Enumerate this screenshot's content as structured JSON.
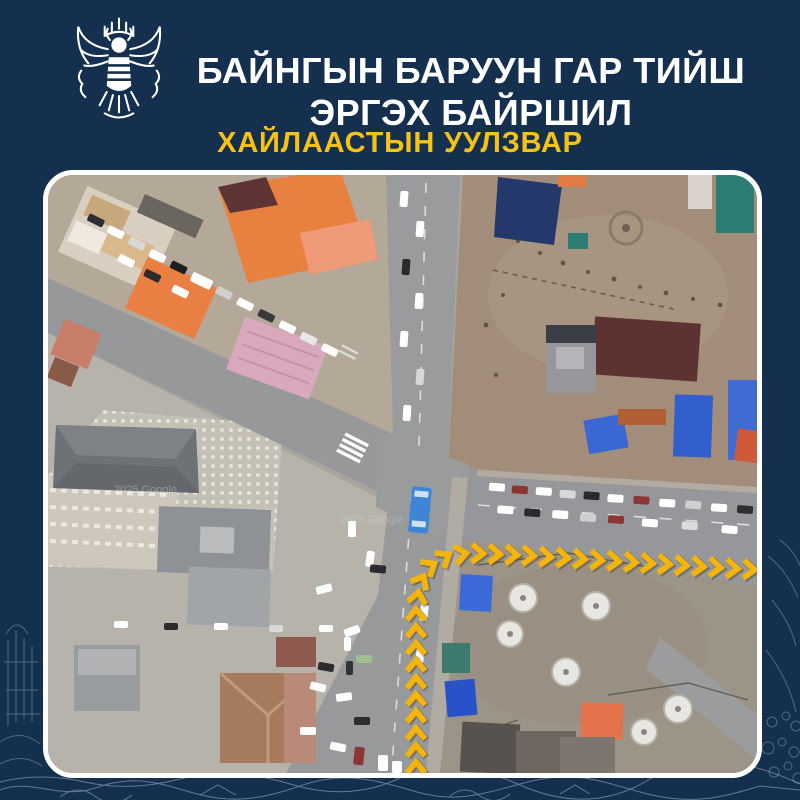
{
  "colors": {
    "background": "#15304e",
    "title_text": "#ffffff",
    "subtitle_text": "#f6c216",
    "map_border": "#ffffff",
    "route_chevron": "#f3b40b",
    "route_shadow": "#4b4237"
  },
  "header": {
    "emblem": "traffic-police-garuda-emblem",
    "title_line1": "БАЙНГЫН БАРУУН ГАР ТИЙШ",
    "title_line2": "ЭРГЭХ БАЙРШИЛ",
    "subtitle": "ХАЙЛААСТЫН УУЛЗВАР"
  },
  "map": {
    "kind": "satellite-imagery-of-intersection",
    "watermark": "2025 Google",
    "route": {
      "description": "permanent-right-turn-from-south-to-east",
      "points": [
        [
          368,
          598
        ],
        [
          368,
          432
        ],
        [
          372,
          408
        ],
        [
          381,
          392
        ],
        [
          397,
          382
        ],
        [
          420,
          378
        ],
        [
          470,
          380
        ],
        [
          709,
          395
        ]
      ],
      "spacing": 17,
      "color": "#f3b40b",
      "shadow": "#4b4237"
    }
  }
}
